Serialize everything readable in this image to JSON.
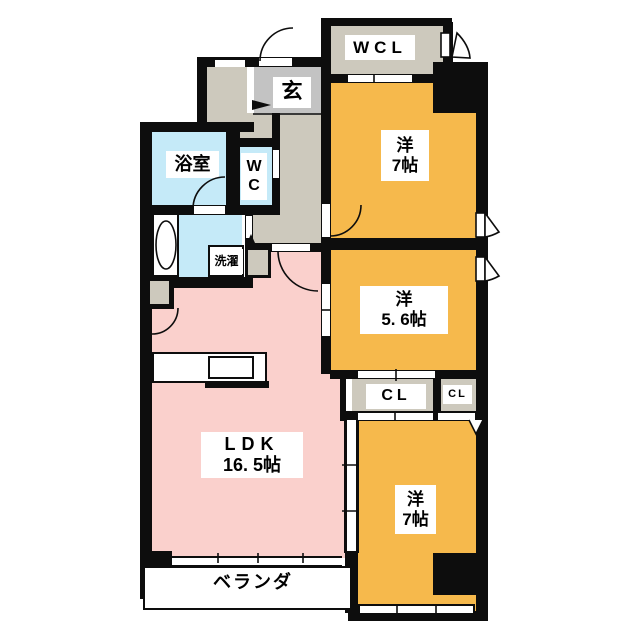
{
  "title": "apartment-floorplan",
  "colors": {
    "wall": "#0d0d0d",
    "bedroom_orange": "#f6b94c",
    "ldk_pink": "#fad0cc",
    "wet_blue": "#c5eaf8",
    "entrance_gray": "#c3c3c3",
    "hall_beige": "#cdc9bd"
  },
  "rooms": {
    "wcl": "WCL",
    "entrance": "玄",
    "bathroom": "浴室",
    "toilet_line1": "W",
    "toilet_line2": "C",
    "laundry": "洗濯",
    "bedroom1_line1": "洋",
    "bedroom1_line2": "7帖",
    "bedroom2_line1": "洋",
    "bedroom2_line2": "5. 6帖",
    "bedroom3_line1": "洋",
    "bedroom3_line2": "7帖",
    "closet_large": "CL",
    "closet_small": "CL",
    "ldk_line1": "LDK",
    "ldk_line2": "16. 5帖",
    "veranda": "ベランダ"
  }
}
